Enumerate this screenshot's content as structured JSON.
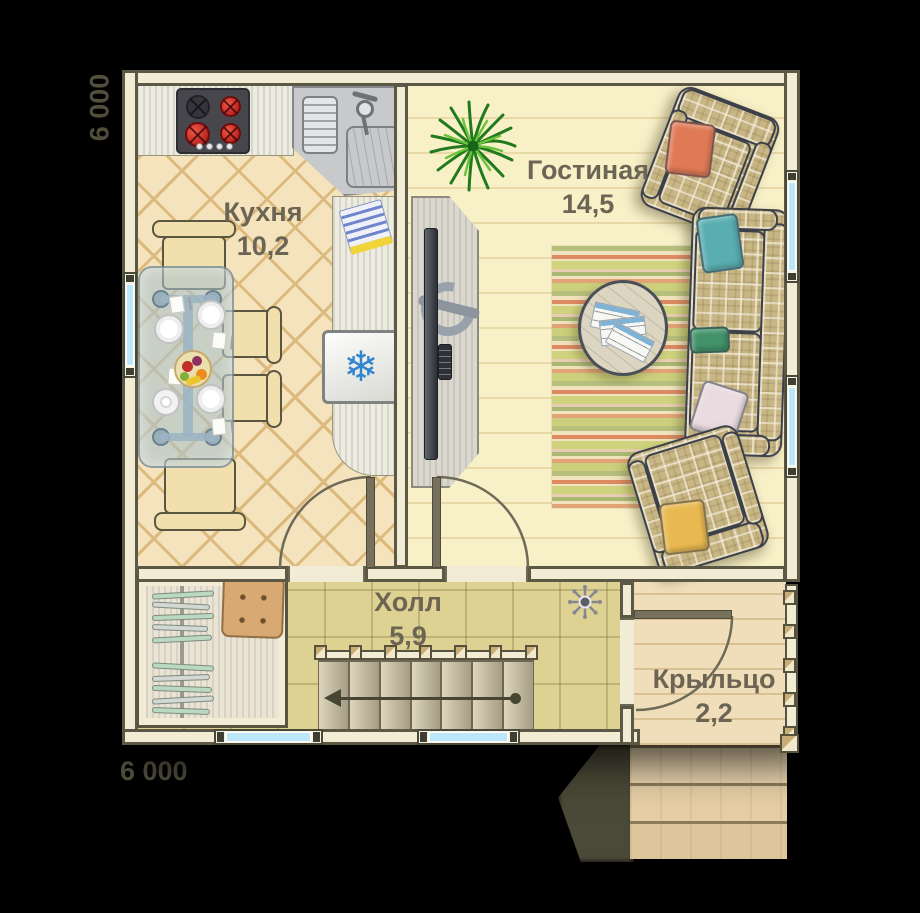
{
  "rooms": {
    "kitchen": {
      "name": "Кухня",
      "area": "10,2"
    },
    "living": {
      "name": "Гостиная",
      "area": "14,5"
    },
    "hall": {
      "name": "Холл",
      "area": "5,9"
    },
    "porch": {
      "name": "Крыльцо",
      "area": "2,2"
    }
  },
  "dimensions": {
    "left": "6 000",
    "bottom": "6 000"
  },
  "icons": {
    "snowflake": "❄"
  },
  "colors": {
    "wall_fill": "#f2ecd4",
    "wall_line": "#5b5946",
    "kitchen_floor": "#f4e3bc",
    "kitchen_lattice": "#dcba7e",
    "living_floor": "#f8f0c7",
    "living_line": "#e8d9a7",
    "hall_floor": "#ded293",
    "porch_floor": "#f0deba",
    "porch_line": "#d9c194",
    "window_glass": "#bce7f8",
    "label_text": "#6d6554",
    "dim_text": "#53503e",
    "snowflake_blue": "#2f86cf",
    "plaid_base": "#c9b685",
    "pillow_orange": "#e07a56",
    "pillow_teal": "#5aaeb2",
    "pillow_green": "#43926a",
    "pillow_pink": "#eadbe0",
    "pillow_yellow": "#e9b951",
    "shadow": "#504d3a"
  }
}
